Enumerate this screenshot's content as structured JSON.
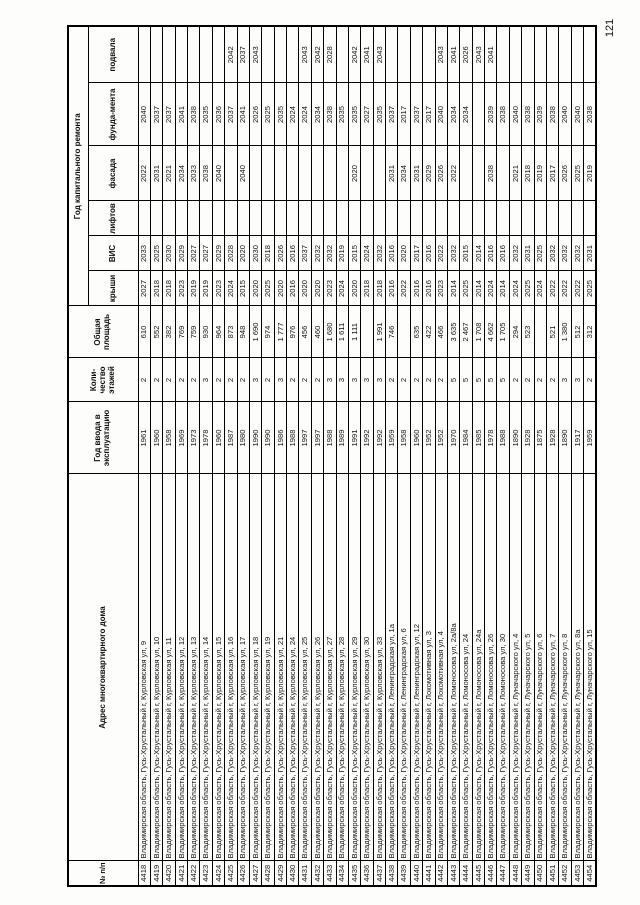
{
  "page_number": "121",
  "table": {
    "headers": {
      "num": "№ п/п",
      "address": "Адрес многоквартирного дома",
      "year_built": "Год ввода в эксплуатацию",
      "floors": "Коли-чество этажей",
      "area": "Общая площадь",
      "repair_group": "Год капитального ремонта",
      "repair_cols": [
        "крыши",
        "ВИС",
        "лифтов",
        "фасада",
        "фунда-мента",
        "подвала"
      ]
    },
    "rows": [
      [
        "4418",
        "Владимирская область, Гусь-Хрустальный г, Курловская ул, 9",
        "1961",
        "2",
        "610",
        "2027",
        "2033",
        "",
        "2022",
        "2040",
        ""
      ],
      [
        "4419",
        "Владимирская область, Гусь-Хрустальный г, Курловская ул, 10",
        "1960",
        "2",
        "552",
        "2018",
        "2025",
        "",
        "2031",
        "2037",
        ""
      ],
      [
        "4420",
        "Владимирская область, Гусь-Хрустальный г, Курловская ул, 11",
        "1958",
        "2",
        "382",
        "2018",
        "2030",
        "",
        "2021",
        "2037",
        ""
      ],
      [
        "4421",
        "Владимирская область, Гусь-Хрустальный г, Курловская ул, 12",
        "1969",
        "2",
        "769",
        "2023",
        "2029",
        "",
        "2034",
        "2041",
        ""
      ],
      [
        "4422",
        "Владимирская область, Гусь-Хрустальный г, Курловская ул, 13",
        "1973",
        "2",
        "759",
        "2019",
        "2027",
        "",
        "2033",
        "2038",
        ""
      ],
      [
        "4423",
        "Владимирская область, Гусь-Хрустальный г, Курловская ул, 14",
        "1978",
        "3",
        "930",
        "2019",
        "2027",
        "",
        "2038",
        "2035",
        ""
      ],
      [
        "4424",
        "Владимирская область, Гусь-Хрустальный г, Курловская ул, 15",
        "1960",
        "2",
        "964",
        "2023",
        "2029",
        "",
        "2040",
        "2036",
        ""
      ],
      [
        "4425",
        "Владимирская область, Гусь-Хрустальный г, Курловская ул, 16",
        "1987",
        "2",
        "873",
        "2024",
        "2028",
        "",
        "",
        "2037",
        "2042"
      ],
      [
        "4426",
        "Владимирская область, Гусь-Хрустальный г, Курловская ул, 17",
        "1980",
        "2",
        "948",
        "2015",
        "2020",
        "",
        "2040",
        "2041",
        "2037"
      ],
      [
        "4427",
        "Владимирская область, Гусь-Хрустальный г, Курловская ул, 18",
        "1990",
        "3",
        "1 690",
        "2020",
        "2030",
        "",
        "",
        "2026",
        "2043"
      ],
      [
        "4428",
        "Владимирская область, Гусь-Хрустальный г, Курловская ул, 19",
        "1990",
        "2",
        "974",
        "2025",
        "2018",
        "",
        "",
        "2025",
        ""
      ],
      [
        "4429",
        "Владимирская область, Гусь-Хрустальный г, Курловская ул, 21",
        "1986",
        "3",
        "1 777",
        "2020",
        "2026",
        "",
        "",
        "2035",
        ""
      ],
      [
        "4430",
        "Владимирская область, Гусь-Хрустальный г, Курловская ул, 24",
        "1988",
        "2",
        "976",
        "2016",
        "2016",
        "",
        "",
        "2024",
        ""
      ],
      [
        "4431",
        "Владимирская область, Гусь-Хрустальный г, Курловская ул, 25",
        "1997",
        "2",
        "456",
        "2020",
        "2037",
        "",
        "",
        "2024",
        "2043"
      ],
      [
        "4432",
        "Владимирская область, Гусь-Хрустальный г, Курловская ул, 26",
        "1997",
        "2",
        "460",
        "2020",
        "2032",
        "",
        "",
        "2034",
        "2042"
      ],
      [
        "4433",
        "Владимирская область, Гусь-Хрустальный г, Курловская ул, 27",
        "1988",
        "3",
        "1 680",
        "2023",
        "2032",
        "",
        "",
        "2038",
        "2028"
      ],
      [
        "4434",
        "Владимирская область, Гусь-Хрустальный г, Курловская ул, 28",
        "1989",
        "3",
        "1 611",
        "2024",
        "2019",
        "",
        "",
        "2035",
        ""
      ],
      [
        "4435",
        "Владимирская область, Гусь-Хрустальный г, Курловская ул, 29",
        "1991",
        "3",
        "1 111",
        "2020",
        "2015",
        "",
        "2020",
        "2035",
        "2042"
      ],
      [
        "4436",
        "Владимирская область, Гусь-Хрустальный г, Курловская ул, 30",
        "1992",
        "3",
        "",
        "2018",
        "2024",
        "",
        "",
        "2027",
        "2041"
      ],
      [
        "4437",
        "Владимирская область, Гусь-Хрустальный г, Курловская ул, 33",
        "1992",
        "3",
        "1 991",
        "2018",
        "2032",
        "",
        "",
        "2035",
        "2043"
      ],
      [
        "4438",
        "Владимирская область, Гусь-Хрустальный г, Ленинградская ул, 1а",
        "1959",
        "2",
        "746",
        "2016",
        "2016",
        "",
        "2031",
        "2037",
        ""
      ],
      [
        "4439",
        "Владимирская область, Гусь-Хрустальный г, Ленинградская ул, 6",
        "1958",
        "2",
        "",
        "2022",
        "2020",
        "",
        "2034",
        "2017",
        ""
      ],
      [
        "4440",
        "Владимирская область, Гусь-Хрустальный г, Ленинградская ул, 12",
        "1960",
        "2",
        "635",
        "2016",
        "2017",
        "",
        "2031",
        "2037",
        ""
      ],
      [
        "4441",
        "Владимирская область, Гусь-Хрустальный г, Локомотивная ул, 3",
        "1952",
        "2",
        "422",
        "2016",
        "2016",
        "",
        "2029",
        "2017",
        ""
      ],
      [
        "4442",
        "Владимирская область, Гусь-Хрустальный г, Локомотивная ул, 4",
        "1952",
        "2",
        "466",
        "2023",
        "2022",
        "",
        "2026",
        "2040",
        "2043"
      ],
      [
        "4443",
        "Владимирская область, Гусь-Хрустальный г, Ломоносова ул, 2а/8а",
        "1970",
        "5",
        "3 635",
        "2014",
        "2032",
        "",
        "2022",
        "2034",
        "2041"
      ],
      [
        "4444",
        "Владимирская область, Гусь-Хрустальный г, Ломоносова ул, 24",
        "1984",
        "5",
        "2 467",
        "2025",
        "2015",
        "",
        "",
        "2034",
        "2026"
      ],
      [
        "4445",
        "Владимирская область, Гусь-Хрустальный г, Ломоносова ул, 24а",
        "1985",
        "5",
        "1 708",
        "2014",
        "2014",
        "",
        "",
        "",
        "2043"
      ],
      [
        "4446",
        "Владимирская область, Гусь-Хрустальный г, Ломоносова ул, 26",
        "1978",
        "5",
        "4 662",
        "2024",
        "2016",
        "",
        "2038",
        "2039",
        "2041"
      ],
      [
        "4447",
        "Владимирская область, Гусь-Хрустальный г, Ломоносова ул, 30",
        "1988",
        "5",
        "1 705",
        "2014",
        "2016",
        "",
        "",
        "2038",
        ""
      ],
      [
        "4448",
        "Владимирская область, Гусь-Хрустальный г, Луначарского ул, 4",
        "1890",
        "2",
        "294",
        "2024",
        "2032",
        "",
        "2021",
        "2040",
        ""
      ],
      [
        "4449",
        "Владимирская область, Гусь-Хрустальный г, Луначарского ул, 5",
        "1928",
        "2",
        "523",
        "2025",
        "2031",
        "",
        "2018",
        "2038",
        ""
      ],
      [
        "4450",
        "Владимирская область, Гусь-Хрустальный г, Луначарского ул, 6",
        "1875",
        "2",
        "",
        "2024",
        "2025",
        "",
        "2019",
        "2039",
        ""
      ],
      [
        "4451",
        "Владимирская область, Гусь-Хрустальный г, Луначарского ул, 7",
        "1928",
        "2",
        "521",
        "2022",
        "2032",
        "",
        "2017",
        "2038",
        ""
      ],
      [
        "4452",
        "Владимирская область, Гусь-Хрустальный г, Луначарского ул, 8",
        "1890",
        "3",
        "1 380",
        "2022",
        "2032",
        "",
        "2026",
        "2040",
        ""
      ],
      [
        "4453",
        "Владимирская область, Гусь-Хрустальный г, Луначарского ул, 8а",
        "1917",
        "3",
        "512",
        "2022",
        "2032",
        "",
        "2025",
        "2040",
        ""
      ],
      [
        "4454",
        "Владимирская область, Гусь-Хрустальный г, Луначарского ул, 15",
        "1959",
        "2",
        "312",
        "2025",
        "2031",
        "",
        "2019",
        "2038",
        ""
      ]
    ]
  }
}
